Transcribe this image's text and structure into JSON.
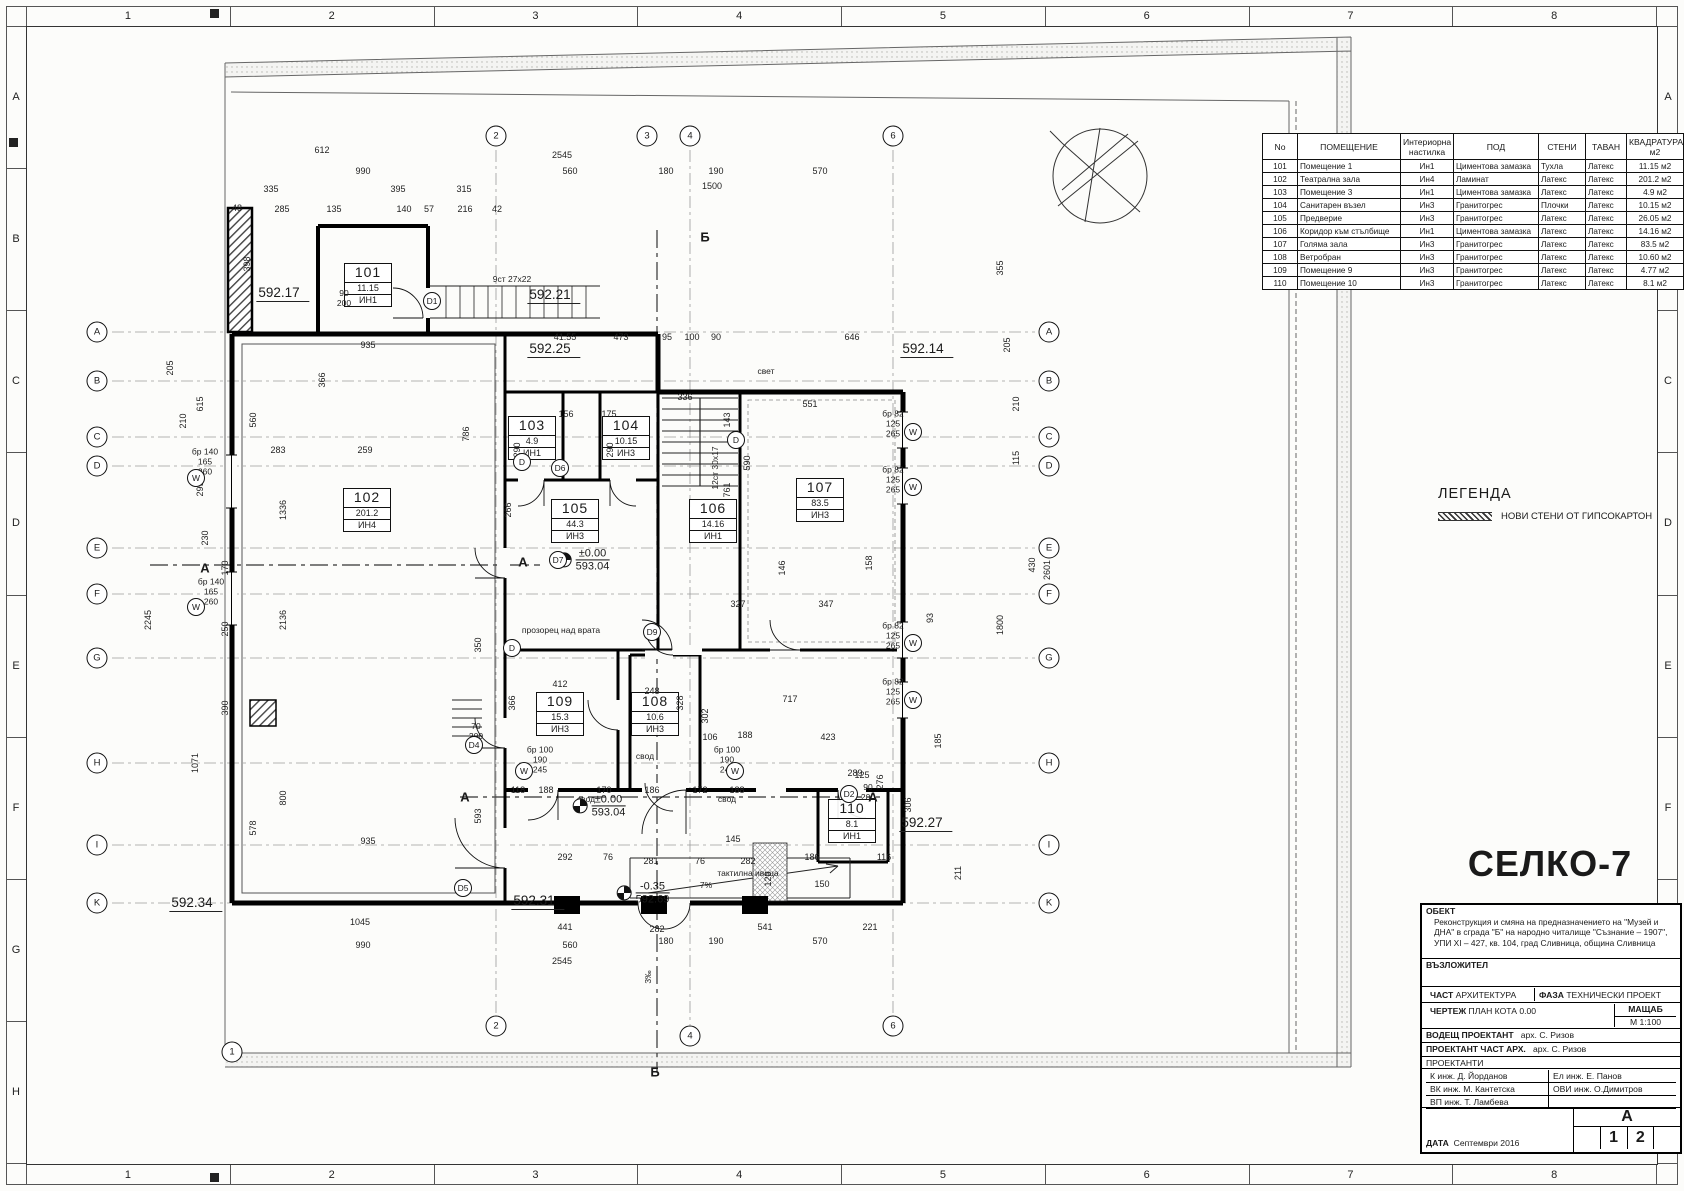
{
  "frame": {
    "top_numbers": [
      "1",
      "2",
      "3",
      "4",
      "5",
      "6",
      "7",
      "8"
    ],
    "side_letters": [
      "A",
      "B",
      "C",
      "D",
      "E",
      "F",
      "G",
      "H"
    ]
  },
  "schedule": {
    "headers": [
      "No",
      "ПОМЕЩЕНИЕ",
      "Интериорна\nнастилка",
      "ПОД",
      "СТЕНИ",
      "ТАВАН",
      "КВАДРАТУРА\nм2"
    ],
    "rows": [
      [
        "101",
        "Помещение 1",
        "Ин1",
        "Циментова замазка",
        "Тухла",
        "Латекс",
        "11.15 м2"
      ],
      [
        "102",
        "Театрална зала",
        "Ин4",
        "Ламинат",
        "Латекс",
        "Латекс",
        "201.2 м2"
      ],
      [
        "103",
        "Помещение 3",
        "Ин1",
        "Циментова замазка",
        "Латекс",
        "Латекс",
        "4.9 м2"
      ],
      [
        "104",
        "Санитарен възел",
        "Ин3",
        "Гранитогрес",
        "Плочки",
        "Латекс",
        "10.15 м2"
      ],
      [
        "105",
        "Предверие",
        "Ин3",
        "Гранитогрес",
        "Латекс",
        "Латекс",
        "26.05 м2"
      ],
      [
        "106",
        "Коридор към стълбище",
        "Ин1",
        "Циментова замазка",
        "Латекс",
        "Латекс",
        "14.16 м2"
      ],
      [
        "107",
        "Голяма зала",
        "Ин3",
        "Гранитогрес",
        "Латекс",
        "Латекс",
        "83.5 м2"
      ],
      [
        "108",
        "Ветробран",
        "Ин3",
        "Гранитогрес",
        "Латекс",
        "Латекс",
        "10.60 м2"
      ],
      [
        "109",
        "Помещение 9",
        "Ин3",
        "Гранитогрес",
        "Латекс",
        "Латекс",
        "4.77 м2"
      ],
      [
        "110",
        "Помещение 10",
        "Ин3",
        "Гранитогрес",
        "Латекс",
        "Латекс",
        "8.1 м2"
      ]
    ]
  },
  "legend": {
    "title": "ЛЕГЕНДА",
    "item": "НОВИ СТЕНИ ОТ ГИПСОКАРТОН"
  },
  "titleblock": {
    "logo": "СЕЛКО-7",
    "obekt_label": "ОБЕКТ",
    "obekt_text": "Реконструкция и смяна на предназначението на \"Музей и ДНА\" в сграда \"Б\" на народно читалище \"Съзнание – 1907\", УПИ XI – 427, кв. 104, град Сливница, община Сливница",
    "vazlozhitel_label": "ВЪЗЛОЖИТЕЛ",
    "chast_label": "ЧАСТ",
    "chast": "АРХИТЕКТУРА",
    "faza_label": "ФАЗА",
    "faza": "ТЕХНИЧЕСКИ ПРОЕКТ",
    "chertezh_label": "ЧЕРТЕЖ",
    "chertezh": "ПЛАН КОТА 0.00",
    "mashtab_label": "МАЩАБ",
    "mashtab": "М 1:100",
    "vodesht_label": "ВОДЕЩ ПРОЕКТАНТ",
    "vodesht": "арх. С. Ризов",
    "proektant_label": "ПРОЕКТАНТ ЧАСТ АРХ.",
    "proektant": "арх. С. Ризов",
    "proektanti_label": "ПРОЕКТАНТИ",
    "eng_rows": [
      [
        "К   инж. Д. Йорданов",
        "Ел   инж. Е. Панов"
      ],
      [
        "ВК  инж. М. Кантетска",
        "ОВИ инж. О.Димитров"
      ],
      [
        "ВП  инж. Т. Ламбева",
        ""
      ]
    ],
    "data_label": "ДАТА",
    "date": "Септември 2016",
    "sheet_letter": "А",
    "sheet_numbers": [
      "",
      "1",
      "2",
      ""
    ]
  },
  "plan": {
    "rooms": [
      {
        "num": "101",
        "area": "11.15",
        "fin": "ИН1",
        "x": 368,
        "y": 285
      },
      {
        "num": "102",
        "area": "201.2",
        "fin": "ИН4",
        "x": 367,
        "y": 510
      },
      {
        "num": "103",
        "area": "4.9",
        "fin": "ИН1",
        "x": 532,
        "y": 438
      },
      {
        "num": "104",
        "area": "10.15",
        "fin": "ИН3",
        "x": 626,
        "y": 438
      },
      {
        "num": "105",
        "area": "44.3",
        "fin": "ИН3",
        "x": 575,
        "y": 521
      },
      {
        "num": "106",
        "area": "14.16",
        "fin": "ИН1",
        "x": 713,
        "y": 521
      },
      {
        "num": "107",
        "area": "83.5",
        "fin": "ИН3",
        "x": 820,
        "y": 500
      },
      {
        "num": "109",
        "area": "15.3",
        "fin": "ИН3",
        "x": 560,
        "y": 714
      },
      {
        "num": "108",
        "area": "10.6",
        "fin": "ИН3",
        "x": 655,
        "y": 714
      },
      {
        "num": "110",
        "area": "8.1",
        "fin": "ИН1",
        "x": 852,
        "y": 821
      }
    ],
    "levels": [
      {
        "t": "592.17",
        "x": 283,
        "y": 302
      },
      {
        "t": "592.21",
        "x": 554,
        "y": 304
      },
      {
        "t": "592.25",
        "x": 554,
        "y": 358
      },
      {
        "t": "592.14",
        "x": 927,
        "y": 358
      },
      {
        "t": "592.34",
        "x": 196,
        "y": 912
      },
      {
        "t": "592.31",
        "x": 538,
        "y": 910
      },
      {
        "t": "592.27",
        "x": 926,
        "y": 832
      }
    ],
    "datum": [
      {
        "a": "±0.00",
        "b": "593.04",
        "x": 583,
        "y": 560
      },
      {
        "a": "±0.00",
        "b": "593.04",
        "x": 599,
        "y": 806
      },
      {
        "a": "-0.35",
        "b": "592.69",
        "x": 643,
        "y": 893
      }
    ],
    "grid_letters": [
      "A",
      "B",
      "C",
      "D",
      "E",
      "F",
      "G",
      "H",
      "I",
      "K"
    ],
    "grid_rows_y": [
      332,
      381,
      437,
      466,
      548,
      594,
      658,
      763,
      845,
      903
    ],
    "grid_left_x": 97,
    "grid_right_x": 1049,
    "grid_top": [
      {
        "n": "2",
        "x": 496,
        "y": 136
      },
      {
        "n": "3",
        "x": 647,
        "y": 136
      },
      {
        "n": "4",
        "x": 690,
        "y": 136
      },
      {
        "n": "6",
        "x": 893,
        "y": 136
      }
    ],
    "grid_bottom": [
      {
        "n": "1",
        "x": 232,
        "y": 1052
      },
      {
        "n": "2",
        "x": 496,
        "y": 1026
      },
      {
        "n": "4",
        "x": 690,
        "y": 1036
      },
      {
        "n": "6",
        "x": 893,
        "y": 1026
      }
    ],
    "doors": [
      {
        "l": "D1",
        "x": 432,
        "y": 301
      },
      {
        "l": "D6",
        "x": 560,
        "y": 468
      },
      {
        "l": "D7",
        "x": 558,
        "y": 560
      },
      {
        "l": "D9",
        "x": 652,
        "y": 632
      },
      {
        "l": "D2",
        "x": 849,
        "y": 794
      },
      {
        "l": "D5",
        "x": 463,
        "y": 888
      },
      {
        "l": "D4",
        "x": 474,
        "y": 745
      },
      {
        "l": "D",
        "x": 522,
        "y": 462
      },
      {
        "l": "D",
        "x": 512,
        "y": 648
      },
      {
        "l": "D",
        "x": 736,
        "y": 440
      }
    ],
    "windows": [
      {
        "x": 196,
        "y": 478
      },
      {
        "x": 196,
        "y": 607
      },
      {
        "x": 913,
        "y": 432
      },
      {
        "x": 913,
        "y": 487
      },
      {
        "x": 913,
        "y": 643
      },
      {
        "x": 913,
        "y": 700
      },
      {
        "x": 524,
        "y": 771
      },
      {
        "x": 735,
        "y": 771
      }
    ],
    "sections": [
      {
        "l": "А",
        "x": 205,
        "y": 568
      },
      {
        "l": "А",
        "x": 523,
        "y": 562
      },
      {
        "l": "А",
        "x": 465,
        "y": 797
      },
      {
        "l": "А",
        "x": 873,
        "y": 797
      },
      {
        "l": "Б",
        "x": 705,
        "y": 237
      },
      {
        "l": "Б",
        "x": 655,
        "y": 1072
      }
    ],
    "notes": [
      {
        "t": "9ст 27х22",
        "x": 512,
        "y": 280
      },
      {
        "t": "прозорец над врата",
        "x": 561,
        "y": 631
      },
      {
        "t": "свод",
        "x": 586,
        "y": 800
      },
      {
        "t": "свод",
        "x": 727,
        "y": 800
      },
      {
        "t": "свод",
        "x": 645,
        "y": 757
      },
      {
        "t": "тактилна ивица",
        "x": 748,
        "y": 874
      },
      {
        "t": "7%",
        "x": 706,
        "y": 886
      },
      {
        "t": "12ст 30х17",
        "x": 716,
        "y": 468,
        "v": 1
      },
      {
        "t": "3‰",
        "x": 649,
        "y": 977,
        "v": 1
      },
      {
        "t": "свет",
        "x": 766,
        "y": 372
      },
      {
        "t": "90\n200",
        "x": 344,
        "y": 299
      },
      {
        "t": "70\n200",
        "x": 476,
        "y": 732
      },
      {
        "t": "90\n200",
        "x": 868,
        "y": 793
      },
      {
        "t": "бр 140\n165\n260",
        "x": 205,
        "y": 462
      },
      {
        "t": "бр 140\n165\n260",
        "x": 211,
        "y": 592
      },
      {
        "t": "бр 82\n125\n265",
        "x": 893,
        "y": 424
      },
      {
        "t": "бр 82\n125\n265",
        "x": 893,
        "y": 480
      },
      {
        "t": "бр 82\n125\n265",
        "x": 893,
        "y": 636
      },
      {
        "t": "бр 82\n125\n265",
        "x": 893,
        "y": 692
      },
      {
        "t": "бр 100\n190\n245",
        "x": 540,
        "y": 760
      },
      {
        "t": "бр 100\n190\n245",
        "x": 727,
        "y": 760
      }
    ],
    "dims": [
      {
        "t": "612",
        "x": 322,
        "y": 150
      },
      {
        "t": "2545",
        "x": 562,
        "y": 155
      },
      {
        "t": "990",
        "x": 363,
        "y": 171
      },
      {
        "t": "560",
        "x": 570,
        "y": 171
      },
      {
        "t": "180",
        "x": 666,
        "y": 171
      },
      {
        "t": "190",
        "x": 716,
        "y": 171
      },
      {
        "t": "570",
        "x": 820,
        "y": 171
      },
      {
        "t": "1500",
        "x": 712,
        "y": 186
      },
      {
        "t": "335",
        "x": 271,
        "y": 189
      },
      {
        "t": "395",
        "x": 398,
        "y": 189
      },
      {
        "t": "315",
        "x": 464,
        "y": 189
      },
      {
        "t": "48",
        "x": 237,
        "y": 208
      },
      {
        "t": "285",
        "x": 282,
        "y": 209
      },
      {
        "t": "135",
        "x": 334,
        "y": 209
      },
      {
        "t": "140",
        "x": 404,
        "y": 209
      },
      {
        "t": "57",
        "x": 429,
        "y": 209
      },
      {
        "t": "216",
        "x": 465,
        "y": 209
      },
      {
        "t": "42",
        "x": 497,
        "y": 209
      },
      {
        "t": "398",
        "x": 247,
        "y": 264,
        "v": 1
      },
      {
        "t": "355",
        "x": 1000,
        "y": 268,
        "v": 1
      },
      {
        "t": "41.55",
        "x": 565,
        "y": 337
      },
      {
        "t": "473",
        "x": 621,
        "y": 337
      },
      {
        "t": "95",
        "x": 667,
        "y": 337
      },
      {
        "t": "100",
        "x": 692,
        "y": 337
      },
      {
        "t": "90",
        "x": 716,
        "y": 337
      },
      {
        "t": "646",
        "x": 852,
        "y": 337
      },
      {
        "t": "205",
        "x": 1007,
        "y": 345,
        "v": 1
      },
      {
        "t": "205",
        "x": 170,
        "y": 368,
        "v": 1
      },
      {
        "t": "615",
        "x": 200,
        "y": 404,
        "v": 1
      },
      {
        "t": "935",
        "x": 368,
        "y": 345
      },
      {
        "t": "366",
        "x": 322,
        "y": 380,
        "v": 1
      },
      {
        "t": "551",
        "x": 810,
        "y": 404
      },
      {
        "t": "336",
        "x": 685,
        "y": 397
      },
      {
        "t": "156",
        "x": 566,
        "y": 414
      },
      {
        "t": "175",
        "x": 609,
        "y": 414
      },
      {
        "t": "210",
        "x": 183,
        "y": 421,
        "v": 1
      },
      {
        "t": "210",
        "x": 1016,
        "y": 404,
        "v": 1
      },
      {
        "t": "560",
        "x": 253,
        "y": 420,
        "v": 1
      },
      {
        "t": "290",
        "x": 517,
        "y": 450,
        "v": 1
      },
      {
        "t": "290",
        "x": 610,
        "y": 450,
        "v": 1
      },
      {
        "t": "786",
        "x": 466,
        "y": 434,
        "v": 1
      },
      {
        "t": "283",
        "x": 278,
        "y": 450
      },
      {
        "t": "259",
        "x": 365,
        "y": 450
      },
      {
        "t": "143",
        "x": 727,
        "y": 420,
        "v": 1
      },
      {
        "t": "115",
        "x": 1016,
        "y": 458,
        "v": 1
      },
      {
        "t": "590",
        "x": 747,
        "y": 463,
        "v": 1
      },
      {
        "t": "1336",
        "x": 283,
        "y": 510,
        "v": 1
      },
      {
        "t": "299",
        "x": 200,
        "y": 489,
        "v": 1
      },
      {
        "t": "266",
        "x": 508,
        "y": 510,
        "v": 1
      },
      {
        "t": "761",
        "x": 727,
        "y": 490,
        "v": 1
      },
      {
        "t": "430",
        "x": 1032,
        "y": 565,
        "v": 1
      },
      {
        "t": "2601",
        "x": 1047,
        "y": 570,
        "v": 1
      },
      {
        "t": "2245",
        "x": 148,
        "y": 620,
        "v": 1
      },
      {
        "t": "2136",
        "x": 283,
        "y": 620,
        "v": 1
      },
      {
        "t": "230",
        "x": 205,
        "y": 538,
        "v": 1
      },
      {
        "t": "170",
        "x": 225,
        "y": 568,
        "v": 1
      },
      {
        "t": "250",
        "x": 225,
        "y": 629,
        "v": 1
      },
      {
        "t": "146",
        "x": 782,
        "y": 568,
        "v": 1
      },
      {
        "t": "158",
        "x": 869,
        "y": 563,
        "v": 1
      },
      {
        "t": "1800",
        "x": 1000,
        "y": 625,
        "v": 1
      },
      {
        "t": "93",
        "x": 930,
        "y": 618,
        "v": 1
      },
      {
        "t": "327",
        "x": 738,
        "y": 604
      },
      {
        "t": "347",
        "x": 826,
        "y": 604
      },
      {
        "t": "390",
        "x": 225,
        "y": 708,
        "v": 1
      },
      {
        "t": "350",
        "x": 478,
        "y": 645,
        "v": 1
      },
      {
        "t": "412",
        "x": 560,
        "y": 684
      },
      {
        "t": "248",
        "x": 652,
        "y": 691
      },
      {
        "t": "328",
        "x": 680,
        "y": 703,
        "v": 1
      },
      {
        "t": "302",
        "x": 705,
        "y": 716,
        "v": 1
      },
      {
        "t": "366",
        "x": 512,
        "y": 703,
        "v": 1
      },
      {
        "t": "717",
        "x": 790,
        "y": 699
      },
      {
        "t": "423",
        "x": 828,
        "y": 737
      },
      {
        "t": "188",
        "x": 745,
        "y": 735
      },
      {
        "t": "106",
        "x": 710,
        "y": 737
      },
      {
        "t": "185",
        "x": 938,
        "y": 741,
        "v": 1
      },
      {
        "t": "1071",
        "x": 195,
        "y": 763,
        "v": 1
      },
      {
        "t": "800",
        "x": 283,
        "y": 798,
        "v": 1
      },
      {
        "t": "578",
        "x": 253,
        "y": 828,
        "v": 1
      },
      {
        "t": "593",
        "x": 478,
        "y": 816,
        "v": 1
      },
      {
        "t": "306",
        "x": 908,
        "y": 805,
        "v": 1
      },
      {
        "t": "276",
        "x": 880,
        "y": 782,
        "v": 1
      },
      {
        "t": "289",
        "x": 855,
        "y": 773
      },
      {
        "t": "125",
        "x": 862,
        "y": 775
      },
      {
        "t": "118",
        "x": 518,
        "y": 790
      },
      {
        "t": "188",
        "x": 546,
        "y": 790
      },
      {
        "t": "170",
        "x": 604,
        "y": 790
      },
      {
        "t": "186",
        "x": 652,
        "y": 790
      },
      {
        "t": "172",
        "x": 700,
        "y": 790
      },
      {
        "t": "188",
        "x": 737,
        "y": 790
      },
      {
        "t": "935",
        "x": 368,
        "y": 841
      },
      {
        "t": "145",
        "x": 733,
        "y": 839
      },
      {
        "t": "292",
        "x": 565,
        "y": 857
      },
      {
        "t": "76",
        "x": 608,
        "y": 857
      },
      {
        "t": "281",
        "x": 651,
        "y": 861
      },
      {
        "t": "76",
        "x": 700,
        "y": 861
      },
      {
        "t": "282",
        "x": 748,
        "y": 861
      },
      {
        "t": "186",
        "x": 812,
        "y": 857
      },
      {
        "t": "150",
        "x": 822,
        "y": 884
      },
      {
        "t": "120",
        "x": 768,
        "y": 879,
        "v": 1
      },
      {
        "t": "116",
        "x": 884,
        "y": 857
      },
      {
        "t": "211",
        "x": 958,
        "y": 873,
        "v": 1
      },
      {
        "t": "1045",
        "x": 360,
        "y": 922
      },
      {
        "t": "441",
        "x": 565,
        "y": 927
      },
      {
        "t": "282",
        "x": 657,
        "y": 929
      },
      {
        "t": "541",
        "x": 765,
        "y": 927
      },
      {
        "t": "221",
        "x": 870,
        "y": 927
      },
      {
        "t": "990",
        "x": 363,
        "y": 945
      },
      {
        "t": "560",
        "x": 570,
        "y": 945
      },
      {
        "t": "180",
        "x": 666,
        "y": 941
      },
      {
        "t": "190",
        "x": 716,
        "y": 941
      },
      {
        "t": "570",
        "x": 820,
        "y": 941
      },
      {
        "t": "2545",
        "x": 562,
        "y": 961
      }
    ]
  }
}
